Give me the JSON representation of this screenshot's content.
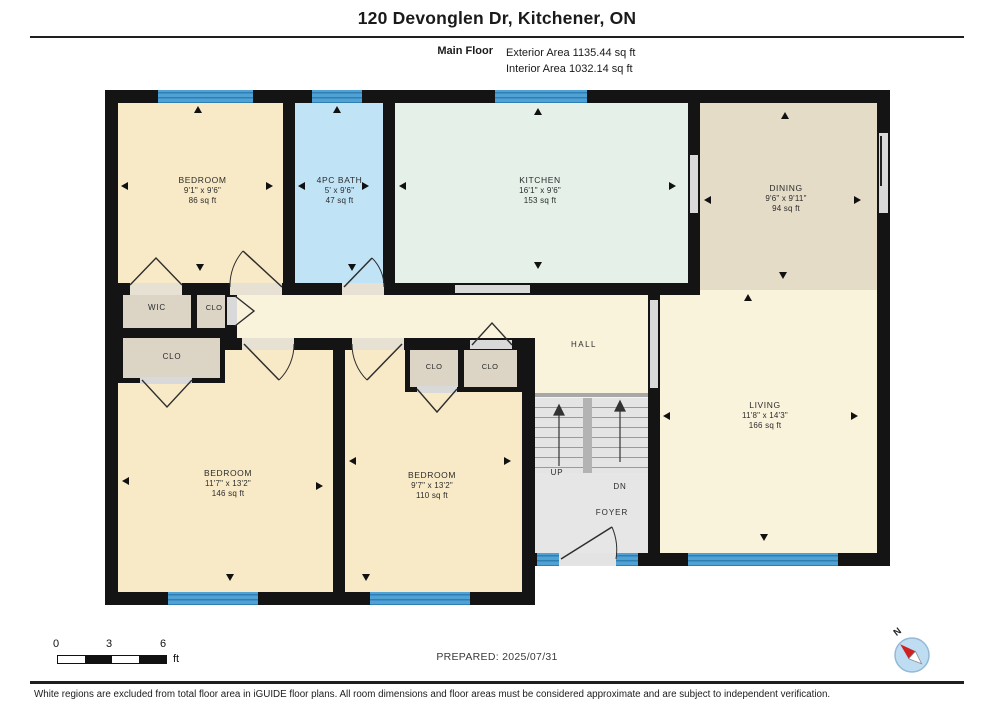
{
  "header": {
    "title": "120 Devonglen Dr, Kitchener, ON",
    "floor_label": "Main Floor",
    "exterior_area": "Exterior Area 1135.44 sq ft",
    "interior_area": "Interior Area 1032.14 sq ft"
  },
  "rooms": {
    "bedroom1": {
      "name": "BEDROOM",
      "dims": "9'1\" x 9'6\"",
      "area": "86 sq ft"
    },
    "bath": {
      "name": "4PC BATH",
      "dims": "5' x 9'6\"",
      "area": "47 sq ft"
    },
    "kitchen": {
      "name": "KITCHEN",
      "dims": "16'1\" x 9'6\"",
      "area": "153 sq ft"
    },
    "dining": {
      "name": "DINING",
      "dims": "9'6\" x 9'11\"",
      "area": "94 sq ft"
    },
    "bedroom2": {
      "name": "BEDROOM",
      "dims": "11'7\" x 13'2\"",
      "area": "146 sq ft"
    },
    "bedroom3": {
      "name": "BEDROOM",
      "dims": "9'7\" x 13'2\"",
      "area": "110 sq ft"
    },
    "living": {
      "name": "LIVING",
      "dims": "11'8\" x 14'3\"",
      "area": "166 sq ft"
    }
  },
  "labels": {
    "wic": "WIC",
    "clo": "CLO",
    "hall": "HALL",
    "up": "UP",
    "dn": "DN",
    "foyer": "FOYER"
  },
  "scale": {
    "tick0": "0",
    "tick1": "3",
    "tick2": "6",
    "unit": "ft"
  },
  "prepared": "PREPARED: 2025/07/31",
  "compass": {
    "north": "N"
  },
  "footer_note": "White regions are excluded from total floor area in iGUIDE floor plans. All room dimensions and floor areas must be considered approximate and are subject to independent verification.",
  "colors": {
    "wall": "#141414",
    "base": "#FAF3DC",
    "bedroom": "#F8EAC6",
    "bath": "#C0E3F6",
    "kitchen": "#E4F0E8",
    "dining": "#E5DCC8",
    "living": "#FAF3DC",
    "closet": "#DCD5C6",
    "stair": "#E4E4E4",
    "foyer": "#E6E6E6",
    "window": "#4FA2D3",
    "windowStripe": "#2F7FB5",
    "opening": "#D9D9D9",
    "doorGap": "#E6E1D3",
    "compassFill": "#BFDDF2",
    "compassRim": "#93B9D6",
    "needleRed": "#CC2222"
  }
}
